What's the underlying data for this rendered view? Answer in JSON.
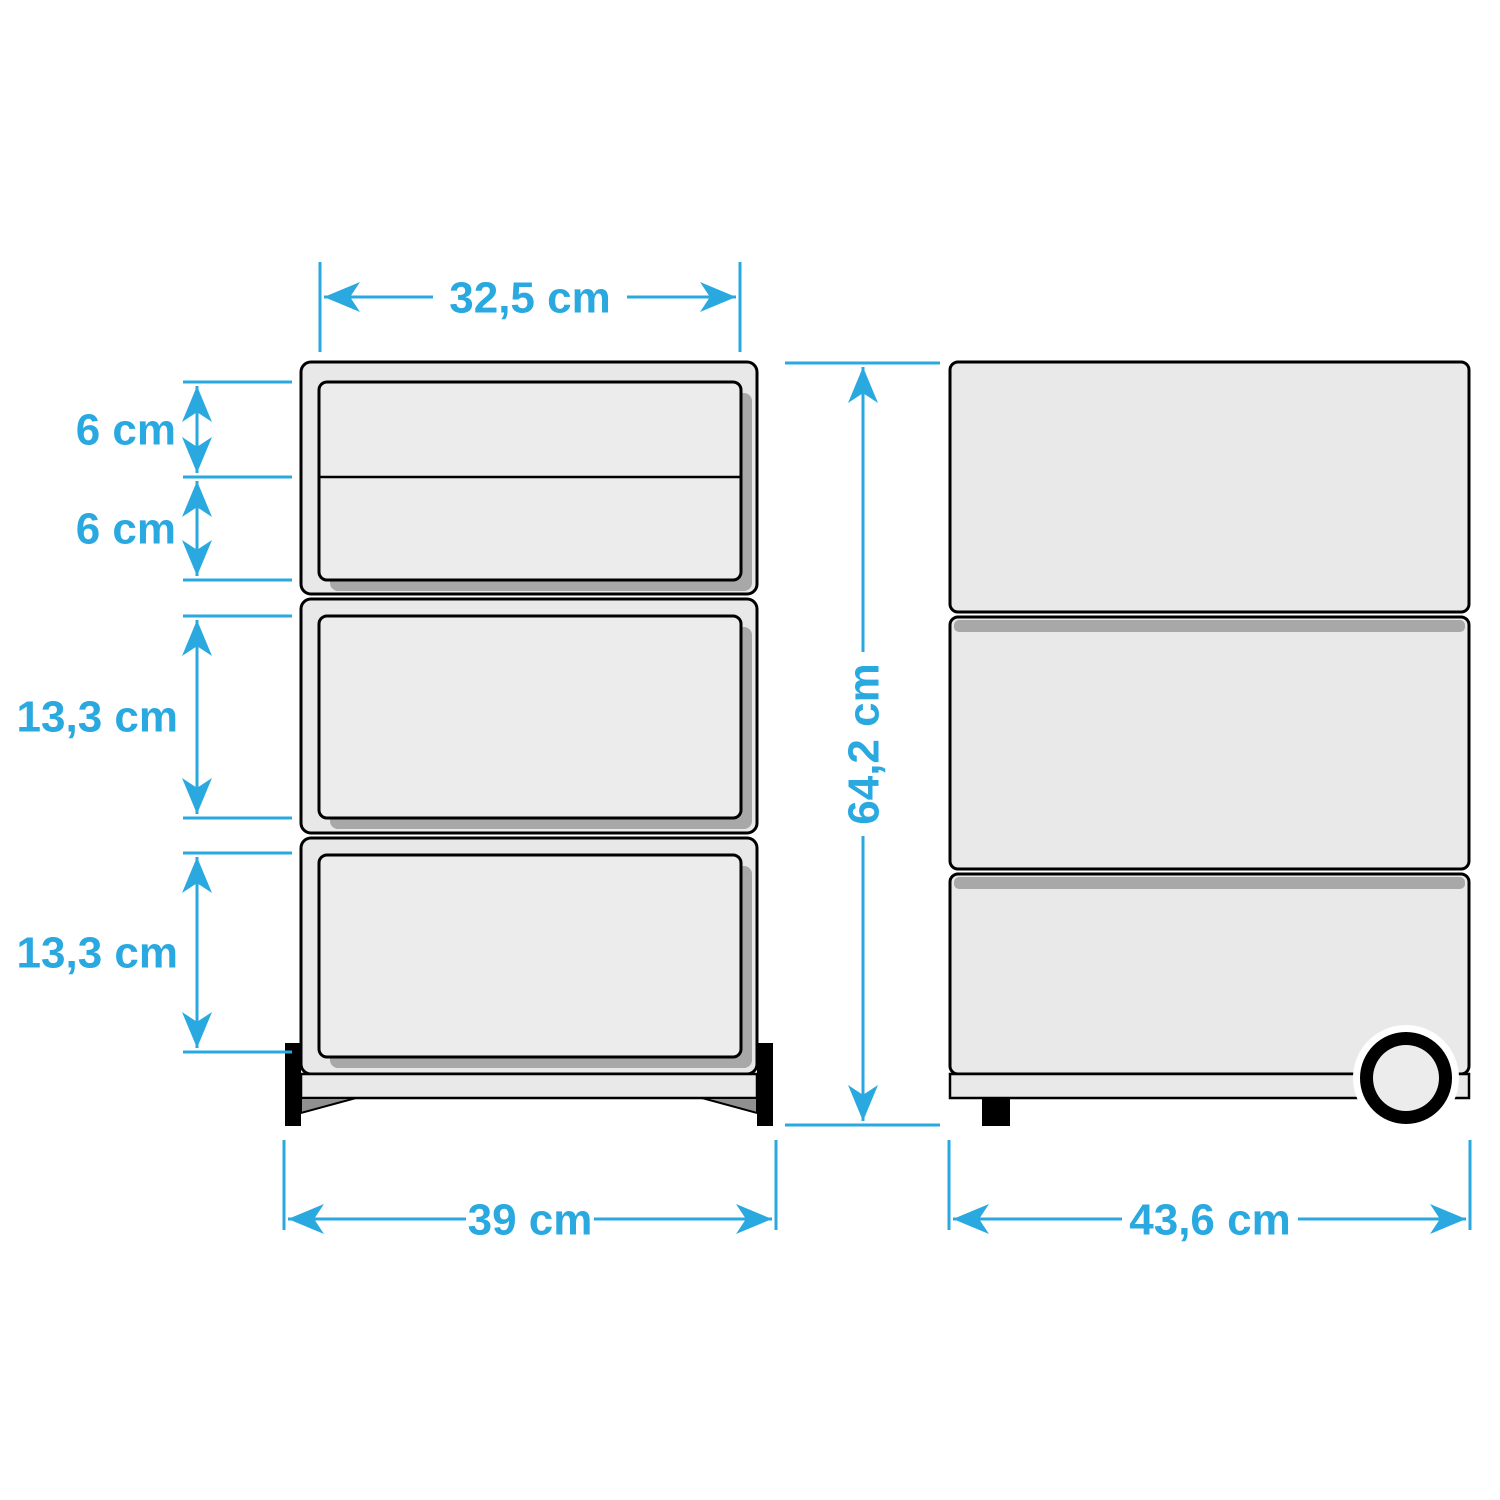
{
  "colors": {
    "accent": "#29a9e0",
    "body_fill": "#e8e8e8",
    "panel_fill": "#ececec",
    "shadow": "#a8a8a8",
    "outline": "#000000",
    "background": "#ffffff"
  },
  "dimensions": {
    "drawer_width": "32,5 cm",
    "drawer_small_1": "6 cm",
    "drawer_small_2": "6 cm",
    "drawer_large_1": "13,3 cm",
    "drawer_large_2": "13,3 cm",
    "overall_height": "64,2 cm",
    "overall_width": "39 cm",
    "overall_depth": "43,6 cm"
  }
}
